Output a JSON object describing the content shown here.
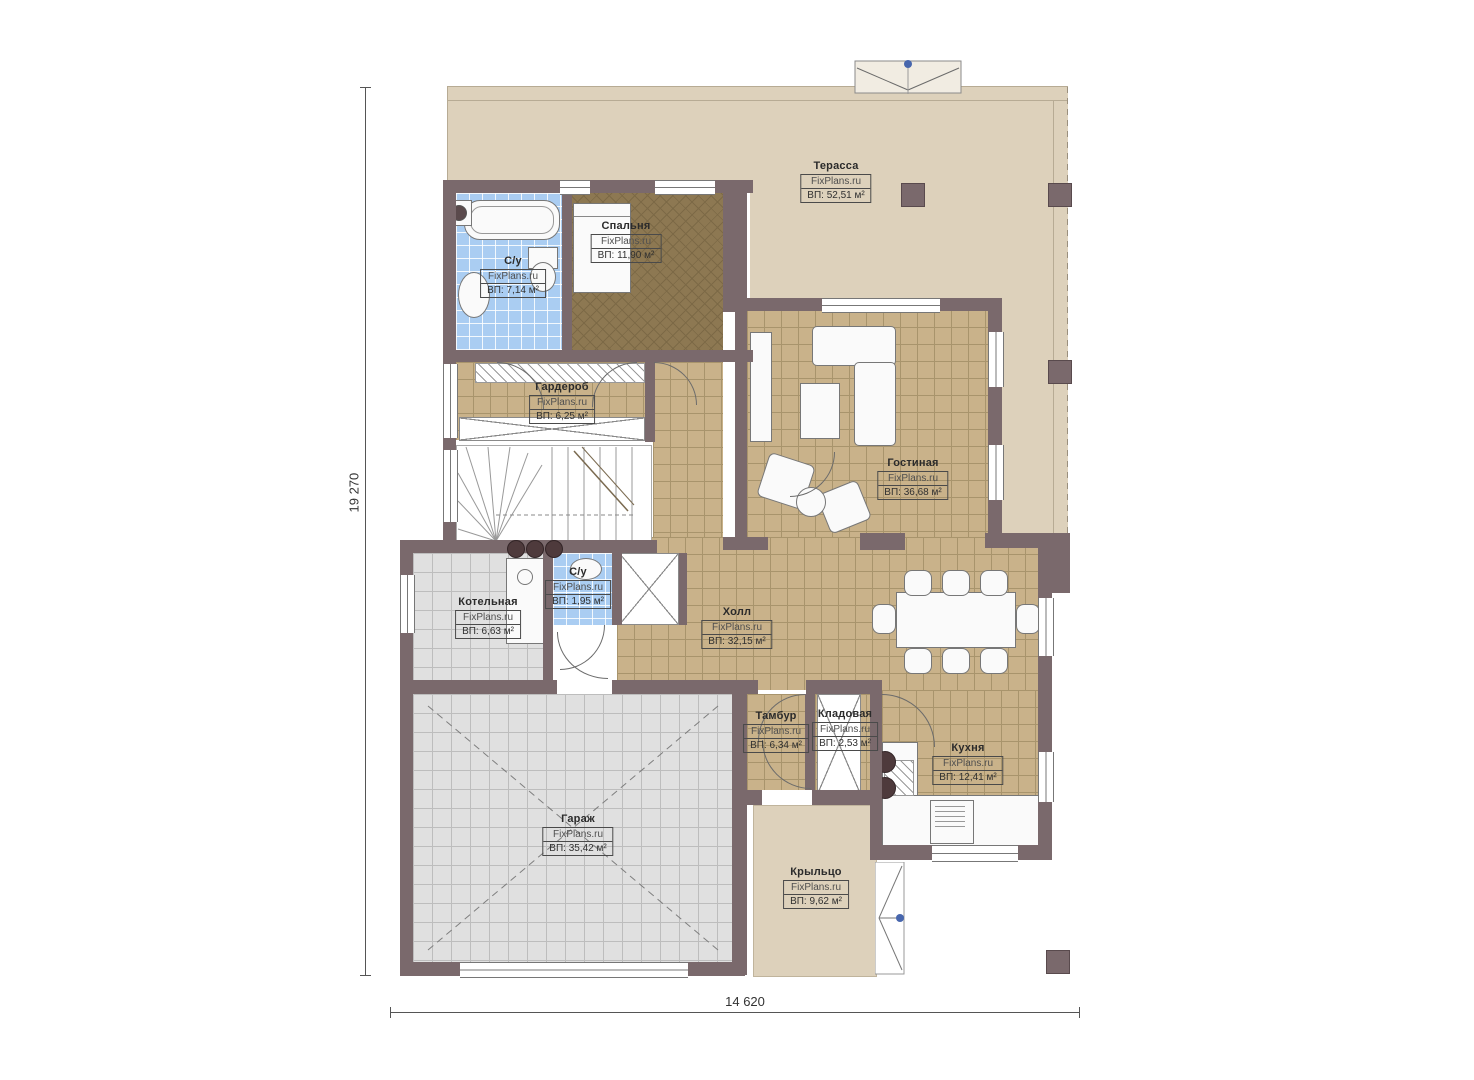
{
  "watermark": "FixPlans.ru",
  "dimensions": {
    "height_label": "19 270",
    "width_label": "14 620"
  },
  "rooms": [
    {
      "name": "Терасса",
      "area": "ВП: 52,51 м²"
    },
    {
      "name": "Спальня",
      "area": "ВП: 11,90 м²"
    },
    {
      "name": "С/у",
      "area": "ВП: 7,14 м²"
    },
    {
      "name": "Гардероб",
      "area": "ВП: 6,25 м²"
    },
    {
      "name": "Гостиная",
      "area": "ВП: 36,68 м²"
    },
    {
      "name": "Котельная",
      "area": "ВП: 6,63 м²"
    },
    {
      "name": "С/у",
      "area": "ВП: 1,95 м²"
    },
    {
      "name": "Холл",
      "area": "ВП: 32,15 м²"
    },
    {
      "name": "Тамбур",
      "area": "ВП: 6,34 м²"
    },
    {
      "name": "Кладовая",
      "area": "ВП: 2,53 м²"
    },
    {
      "name": "Кухня",
      "area": "ВП: 12,41 м²"
    },
    {
      "name": "Гараж",
      "area": "ВП: 35,42 м²"
    },
    {
      "name": "Крыльцо",
      "area": "ВП: 9,62 м²"
    }
  ],
  "colors": {
    "wall": "#7a696c",
    "terrace_floor": "#ddd1bb",
    "tile_floor": "#c9b28a",
    "bath_tile": "#aacdf2",
    "garage_tile": "#e0e0e0",
    "bedroom_carpet": "#8d7852",
    "marker_blue": "#4766ad"
  }
}
